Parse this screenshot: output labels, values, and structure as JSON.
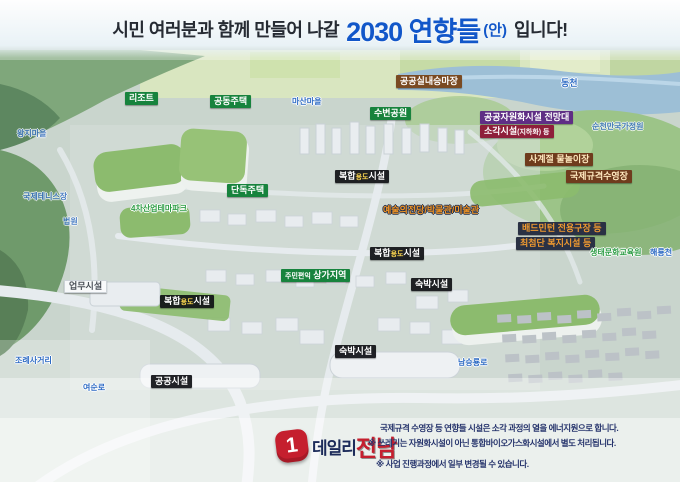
{
  "header": {
    "prefix": "시민 여러분과 함께 만들어 나갈",
    "highlight": "2030 연향들",
    "paren": "(안)",
    "suffix": "입니다!"
  },
  "labels": {
    "resort": "리조트",
    "apartments": "공동주택",
    "masan_village": "마산마을",
    "riding_arena": "공공실내승마장",
    "dongcheon": "동천",
    "waterside_park": "수변공원",
    "observatory": "공공자원화시설 전망대",
    "incinerator_main": "소각시설",
    "incinerator_sub": "(지하화) 등",
    "national_garden": "순천만국가정원",
    "water_play": "사계절 물놀이장",
    "intl_pool": "국제규격수영장",
    "mixed_p1": "복합",
    "mixed_p2": "용도",
    "mixed_p3": "시설",
    "detached": "단독주택",
    "industry_park": "4차산업테마파크",
    "arts_center": "예술의전당/박물관/미술관",
    "badminton": "배드민턴 전용구장 등",
    "welfare": "최첨단 복지시설 등",
    "eco_education": "생태문화교육원",
    "haeryongcheon": "해룡천",
    "lodging": "숙박시설",
    "shopping_small": "주민편익",
    "shopping_main": "상가지역",
    "business": "업무시설",
    "public_facility": "공공시설",
    "namseungryong_ro": "남승룡로",
    "jorye_crossing": "조례사거리",
    "yeosun_ro": "여순로",
    "wangji_village": "왕지마을",
    "intl_tennis": "국제테니스장",
    "court": "법원"
  },
  "footer": {
    "logo_mark": "1",
    "logo_daily": "데일리",
    "logo_jeonnam": "전남",
    "line1": "국제규격 수영장 등 연향들 시설은 소각 과정의 열을 에너지원으로 합니다.",
    "line2": "※ 쓰레기는 자원화시설이 아닌 통합바이오가스화시설에서 별도 처리됩니다.",
    "line3": "※ 사업 진행과정에서 일부 변경될 수 있습니다."
  },
  "colors": {
    "title_blue": "#1257c9",
    "title_dark": "#262b33",
    "logo_red": "#c51f2e",
    "logo_navy": "#1c2b5a",
    "green_box": "#17833d",
    "brown_box": "#7a4a22",
    "amber_box_bg": "#6f3c1d",
    "amber_box_text": "#ffe9bf",
    "purple_box": "#5f2e85",
    "red_box": "#8e1f3a",
    "black_box": "#14161c",
    "box_yellow": "#ffd94f",
    "navy_box": "#2a3144",
    "navy_box_text": "#f09a30",
    "blue_label": "#2e6bc4",
    "green_label": "#2f9e47",
    "orange_label": "#f29422",
    "footer_text": "#27356d"
  }
}
